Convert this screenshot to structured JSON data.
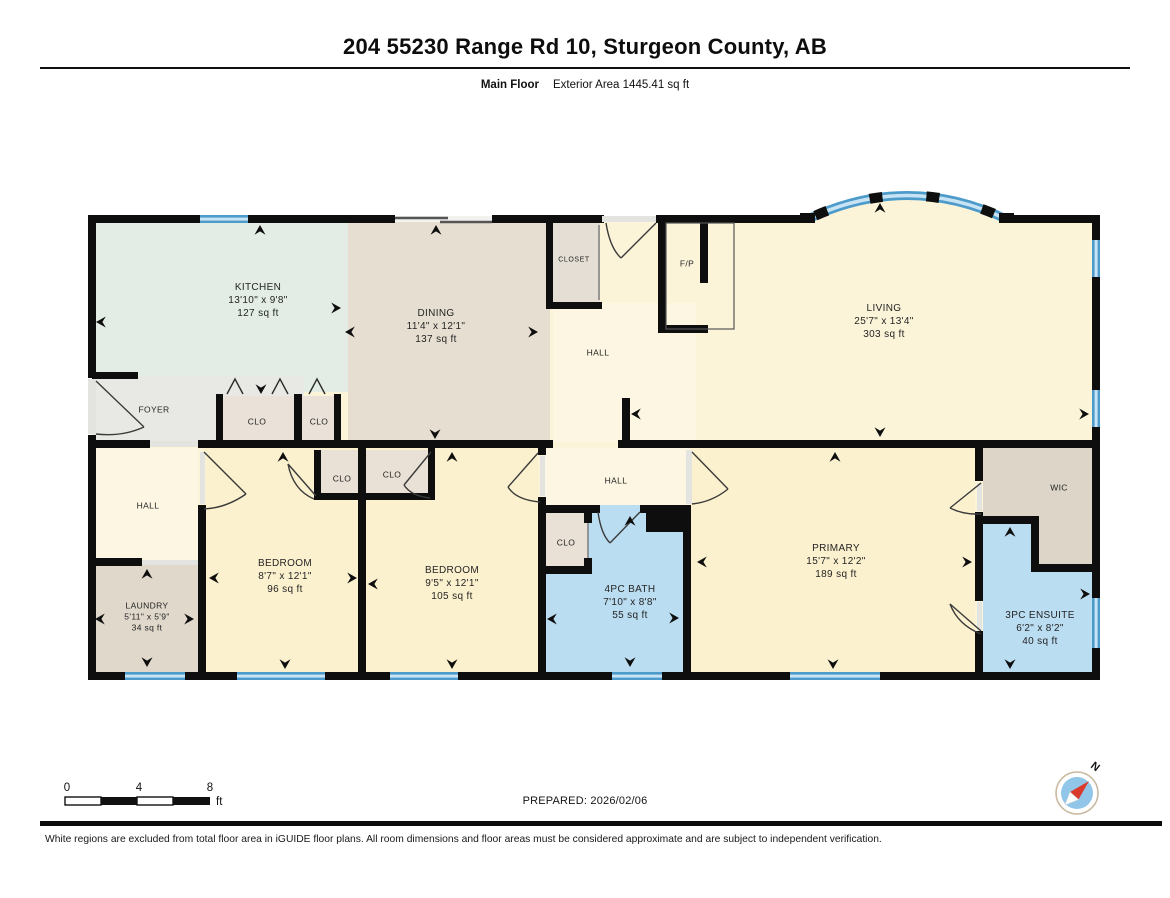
{
  "header": {
    "title": "204 55230 Range Rd 10, Sturgeon County, AB",
    "floor_label": "Main Floor",
    "area_label": "Exterior Area 1445.41 sq ft"
  },
  "rooms": {
    "kitchen": {
      "name": "KITCHEN",
      "dims": "13'10\" x 9'8\"",
      "area": "127 sq ft"
    },
    "dining": {
      "name": "DINING",
      "dims": "11'4\" x 12'1\"",
      "area": "137 sq ft"
    },
    "closet": {
      "name": "CLOSET"
    },
    "fp": {
      "name": "F/P"
    },
    "hall_upper": {
      "name": "HALL"
    },
    "living": {
      "name": "LIVING",
      "dims": "25'7\" x 13'4\"",
      "area": "303 sq ft"
    },
    "foyer": {
      "name": "FOYER"
    },
    "clo_foyer1": {
      "name": "CLO"
    },
    "clo_foyer2": {
      "name": "CLO"
    },
    "hall_lower": {
      "name": "HALL"
    },
    "laundry": {
      "name": "LAUNDRY",
      "dims": "5'11\" x 5'9\"",
      "area": "34 sq ft"
    },
    "bedroom1": {
      "name": "BEDROOM",
      "dims": "8'7\" x 12'1\"",
      "area": "96 sq ft"
    },
    "clo_bed1": {
      "name": "CLO"
    },
    "clo_bed2": {
      "name": "CLO"
    },
    "bedroom2": {
      "name": "BEDROOM",
      "dims": "9'5\" x 12'1\"",
      "area": "105 sq ft"
    },
    "hall_middle": {
      "name": "HALL"
    },
    "clo_bath": {
      "name": "CLO"
    },
    "bath": {
      "name": "4PC BATH",
      "dims": "7'10\" x 8'8\"",
      "area": "55 sq ft"
    },
    "primary": {
      "name": "PRIMARY",
      "dims": "15'7\" x 12'2\"",
      "area": "189 sq ft"
    },
    "wic": {
      "name": "WIC"
    },
    "ensuite": {
      "name": "3PC ENSUITE",
      "dims": "6'2\" x 8'2\"",
      "area": "40 sq ft"
    }
  },
  "footer": {
    "scale": {
      "tick0": "0",
      "tick4": "4",
      "tick8": "8",
      "unit": "ft"
    },
    "prepared": "PREPARED: 2026/02/06",
    "compass_label": "N",
    "disclaimer": "White regions are excluded from total floor area in iGUIDE floor plans. All room dimensions and floor areas must be considered approximate and are subject to independent verification."
  },
  "colors": {
    "wall": "#0e0e0e",
    "cream_room": "#fcf2d2",
    "cream_hall": "#fcf6e2",
    "kitchen_mint": "#e3ede5",
    "dining_tan": "#e6dfd1",
    "gray_foyer": "#e8e8e4",
    "gray_closet": "#e4ded4",
    "gray_wic": "#dcd5c8",
    "laundry_tan": "#dfd8cb",
    "bath_blue": "#bbddf2",
    "window_blue": "#4d9bcb",
    "window_light": "#c7e3f4",
    "compass_red": "#d93a2b"
  }
}
